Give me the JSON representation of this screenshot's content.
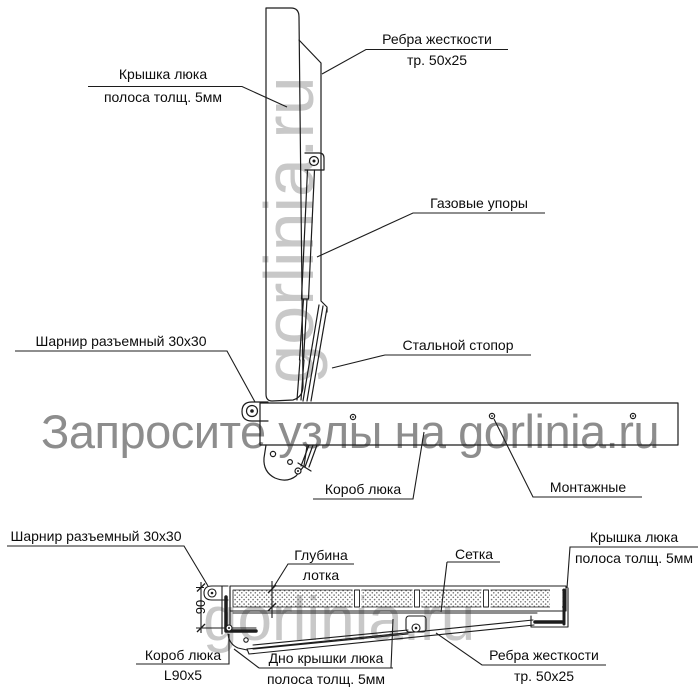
{
  "watermarks": {
    "main": "Запросите узлы на gorlinia.ru",
    "vertical": "gorlinia.ru",
    "section": "gorlinia.ru"
  },
  "side_view": {
    "labels": {
      "cover_line1": "Крышка люка",
      "cover_line2": "полоса толщ. 5мм",
      "ribs_line1": "Ребра жесткости",
      "ribs_line2": "тр. 50x25",
      "gas_struts": "Газовые упоры",
      "steel_stopper": "Стальной стопор",
      "hinge": "Шарнир разъемный 30x30",
      "box": "Короб люка",
      "mounting": "Монтажные"
    }
  },
  "section_view": {
    "labels": {
      "hinge": "Шарнир разъемный 30x30",
      "depth_line1": "Глубина",
      "depth_line2": "лотка",
      "mesh": "Сетка",
      "cover_line1": "Крышка люка",
      "cover_line2": "полоса толщ. 5мм",
      "ribs_line1": "Ребра жесткости",
      "ribs_line2": "тр. 50x25",
      "bottom_line1": "Дно крышки люка",
      "bottom_line2": "полоса толщ. 5мм",
      "box_line1": "Короб люка",
      "box_line2": "L90x5"
    },
    "dimensions": {
      "height": "90"
    }
  },
  "colors": {
    "line": "#1c1c1c",
    "watermark_main": "#8d8d8d",
    "watermark_light": "#c8c8c8"
  }
}
